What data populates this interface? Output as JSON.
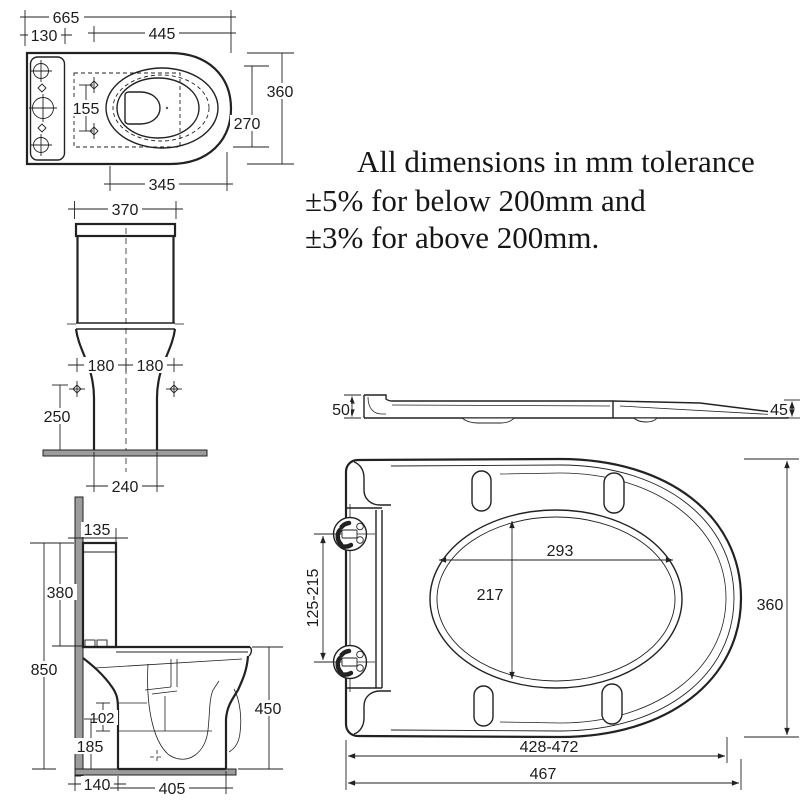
{
  "note": {
    "lines": [
      "All dimensions in mm tolerance",
      "±5% for below 200mm and",
      "±3% for above 200mm."
    ]
  },
  "views": {
    "toilet_top": {
      "overall_length": "665",
      "cistern_depth": "130",
      "seat_length": "445",
      "overall_width": "360",
      "bowl_width": "270",
      "fixing_hole_spacing": "155",
      "bowl_length": "345"
    },
    "toilet_front": {
      "cistern_width": "370",
      "fixing_left": "180",
      "fixing_right": "180",
      "fixing_height": "250",
      "base_width": "240"
    },
    "toilet_side": {
      "cistern_top_depth": "135",
      "cistern_height": "380",
      "overall_height": "850",
      "outlet_offset": "102",
      "outlet_height": "185",
      "bowl_height": "450",
      "wall_to_base": "140",
      "base_depth": "405"
    },
    "seat_side": {
      "hinge_end_thickness": "50",
      "front_thickness": "45"
    },
    "seat_top": {
      "opening_length": "293",
      "opening_width": "217",
      "overall_width": "360",
      "hinge_pitch_range": "125-215",
      "fixing_length_range": "428-472",
      "overall_length": "467"
    }
  },
  "colors": {
    "line": "#222222",
    "surface_gray": "#9c9c9c",
    "background": "#ffffff"
  }
}
